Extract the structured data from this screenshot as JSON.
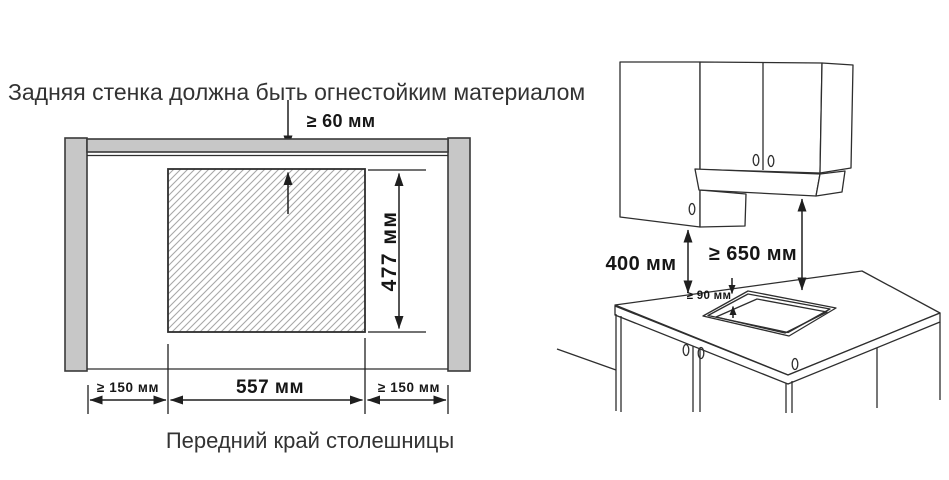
{
  "left_diagram": {
    "title": "Задняя стенка должна быть огнестойким материалом",
    "caption": "Передний край столешницы",
    "dimensions": {
      "top_clearance": "≥ 60 мм",
      "cutout_height": "477 мм",
      "left_margin": "≥ 150 мм",
      "cutout_width": "557 мм",
      "right_margin": "≥ 150 мм"
    }
  },
  "right_diagram": {
    "dimensions": {
      "cabinet_to_counter": "400 мм",
      "hood_to_counter": "≥ 650 мм",
      "cutout_to_edge": "≥ 90 мм"
    }
  },
  "colors": {
    "wall_fill": "#c7c7c7",
    "outline": "#2e2e2e",
    "dimension_line": "#1f1f1f",
    "hatch_line": "#a8a8a8",
    "cooktop_fill": "#8c8c8c",
    "text": "#2b2b2b"
  }
}
